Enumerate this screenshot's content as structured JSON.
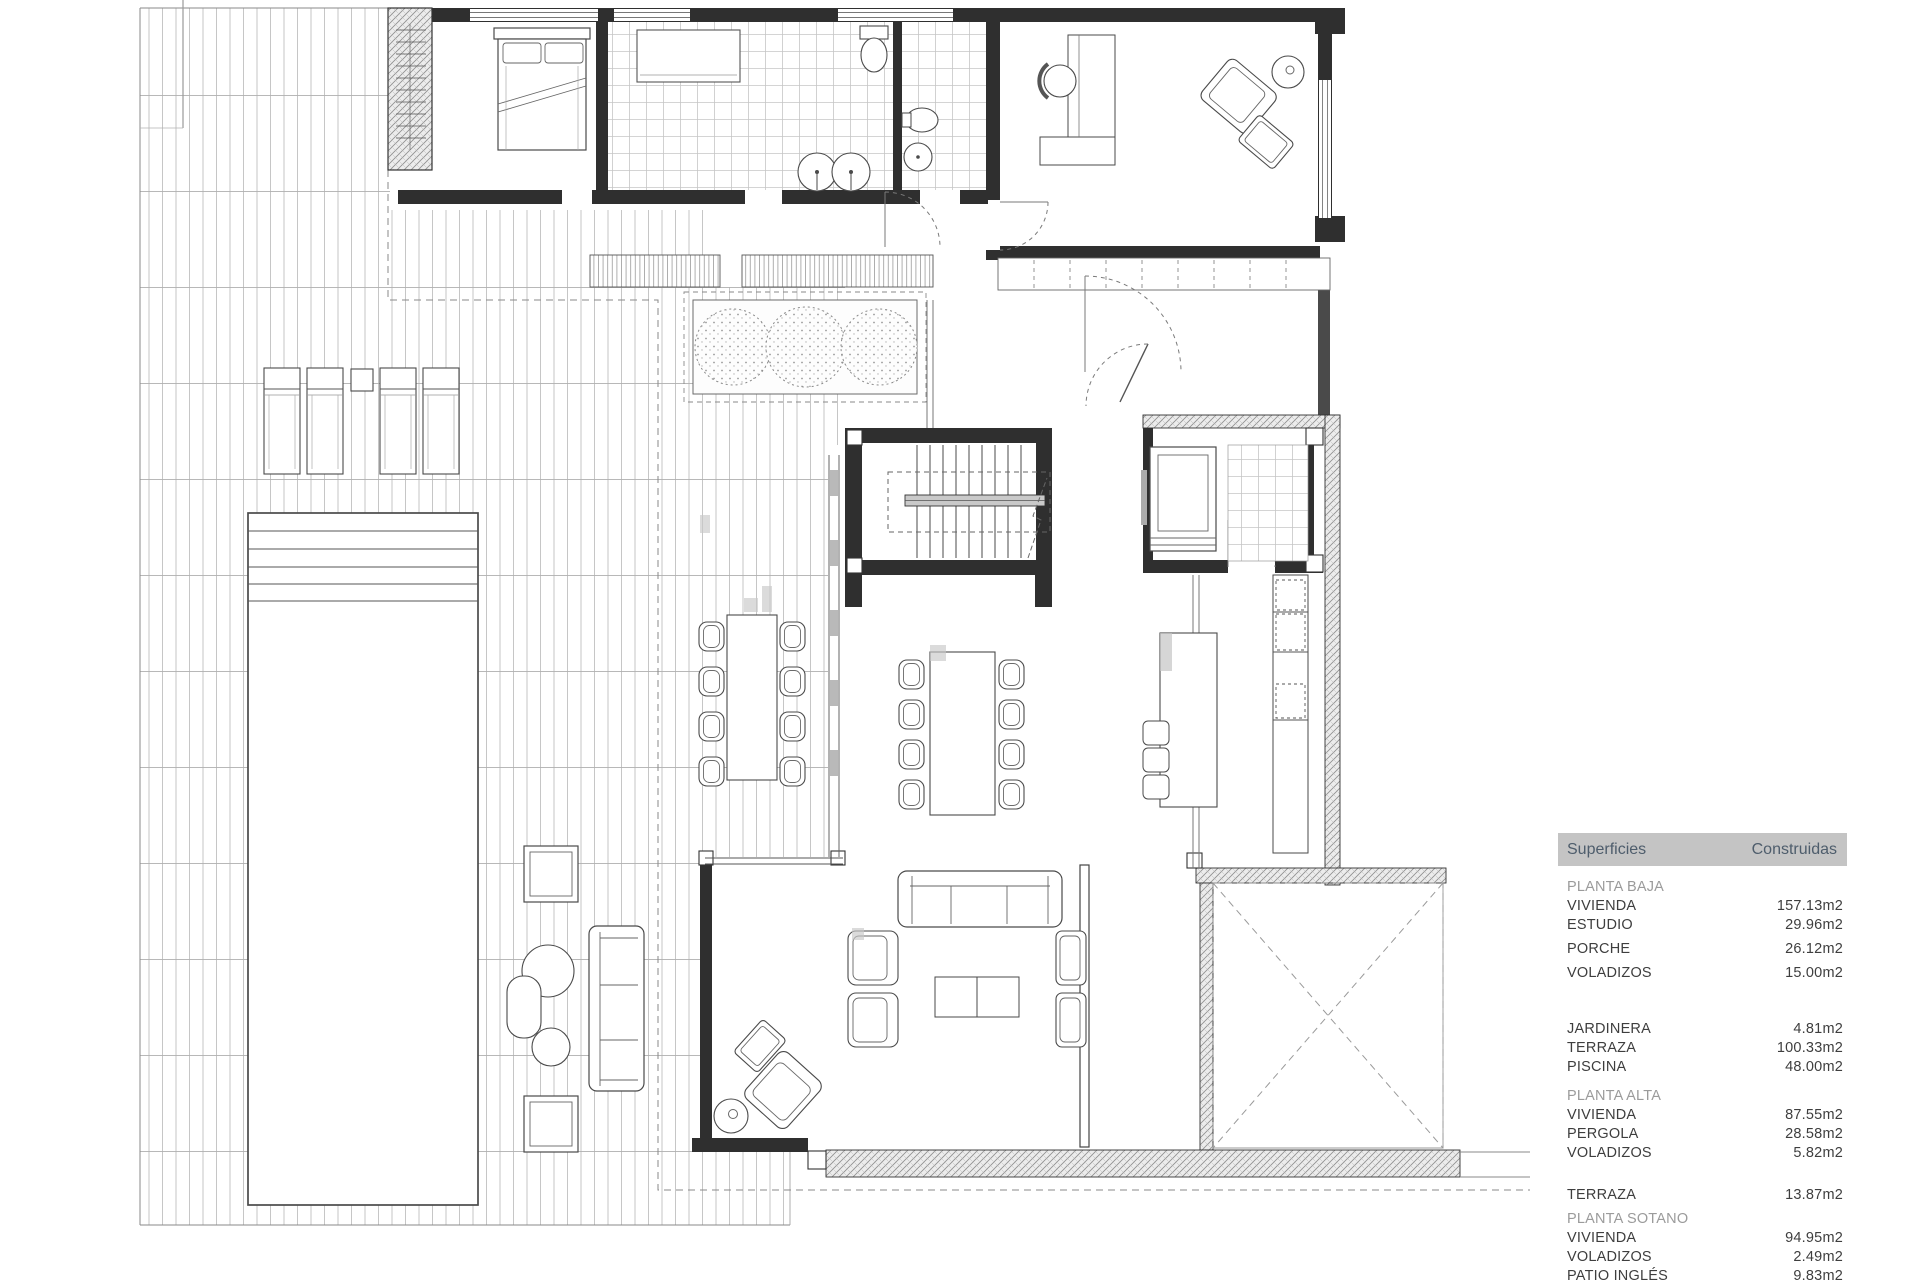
{
  "colors": {
    "header_bg": "#c4c4c4",
    "header_text": "#4e5d6c",
    "section_text": "#9b9b9b",
    "row_text": "#3e3e3e",
    "wall": "#2f2f2f",
    "line": "#555555"
  },
  "legend_table": {
    "header": {
      "col1": "Superficies",
      "col2": "Construidas"
    },
    "rows": [
      {
        "type": "section",
        "label": "PLANTA BAJA"
      },
      {
        "type": "item",
        "label": "VIVIENDA",
        "value": "157.13m2"
      },
      {
        "type": "item",
        "label": "ESTUDIO",
        "value": "29.96m2"
      },
      {
        "type": "item",
        "label": "PORCHE",
        "value": "26.12m2",
        "gap": "sm"
      },
      {
        "type": "item",
        "label": "VOLADIZOS",
        "value": "15.00m2",
        "gap": "sm"
      },
      {
        "type": "item",
        "label": "JARDINERA",
        "value": "4.81m2",
        "gap": "xl"
      },
      {
        "type": "item",
        "label": "TERRAZA",
        "value": "100.33m2"
      },
      {
        "type": "item",
        "label": "PISCINA",
        "value": "48.00m2"
      },
      {
        "type": "section",
        "label": "PLANTA ALTA",
        "gap": "md"
      },
      {
        "type": "item",
        "label": "VIVIENDA",
        "value": "87.55m2"
      },
      {
        "type": "item",
        "label": "PERGOLA",
        "value": "28.58m2"
      },
      {
        "type": "item",
        "label": "VOLADIZOS",
        "value": "5.82m2"
      },
      {
        "type": "item",
        "label": "TERRAZA",
        "value": "13.87m2",
        "gap": "lg"
      },
      {
        "type": "section",
        "label": "PLANTA SOTANO",
        "gap": "sm"
      },
      {
        "type": "item",
        "label": "VIVIENDA",
        "value": "94.95m2"
      },
      {
        "type": "item",
        "label": "VOLADIZOS",
        "value": "2.49m2"
      },
      {
        "type": "item",
        "label": "PATIO INGLÉS",
        "value": "9.83m2"
      }
    ]
  }
}
